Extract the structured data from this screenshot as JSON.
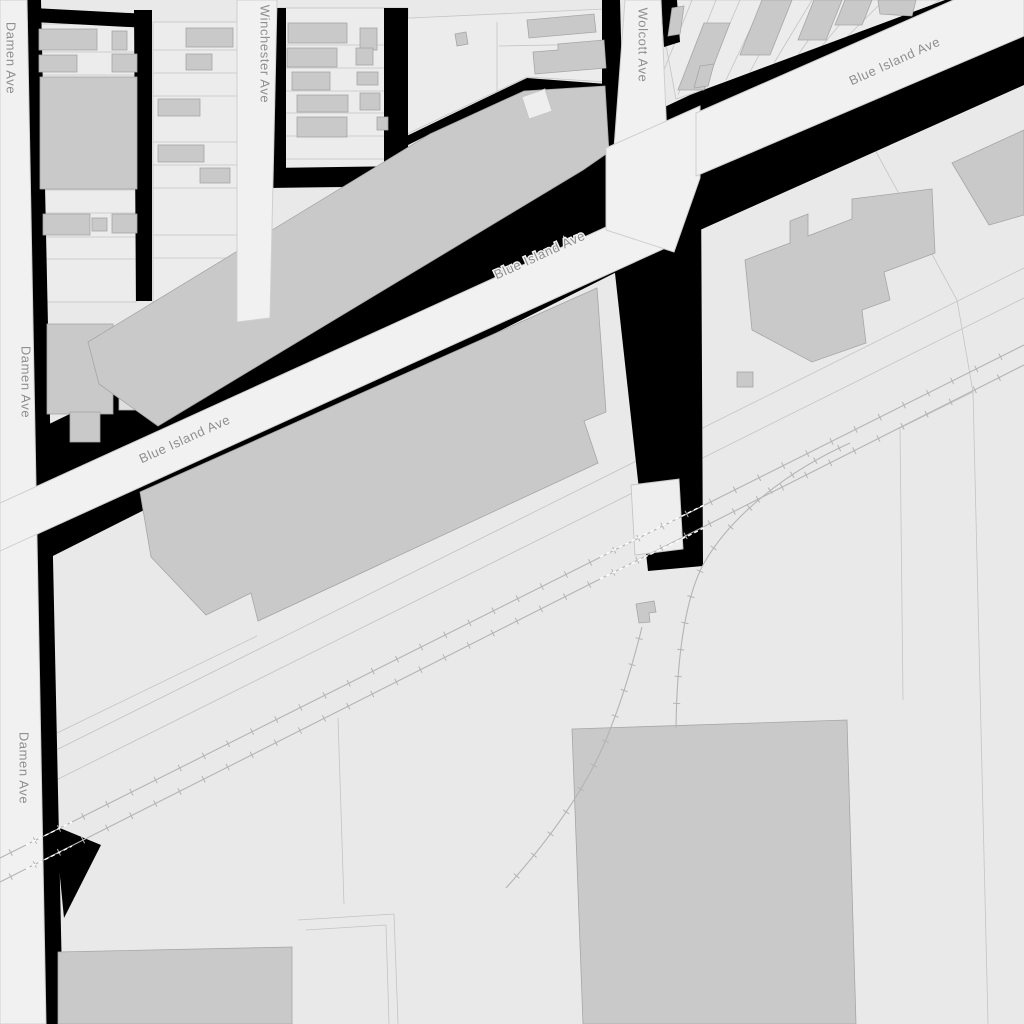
{
  "map": {
    "type": "street-map",
    "street_labels": {
      "damen_top": "Damen Ave",
      "damen_mid": "Damen Ave",
      "damen_bottom": "Damen Ave",
      "winchester": "Winchester Ave",
      "wolcott": "Wolcott Ave",
      "blue_island_west": "Blue Island Ave",
      "blue_island_mid": "Blue Island Ave",
      "blue_island_east": "Blue Island Ave"
    },
    "features": {
      "roads": [
        "Damen Ave",
        "Winchester Ave",
        "Wolcott Ave",
        "Blue Island Ave"
      ],
      "railroad": "twin hatched tracks with two curved spur tracks",
      "buildings": "gray footprints",
      "gaps": "black alley/vacant bands"
    },
    "palette": {
      "background": "#e9e9e9",
      "parcel": "#ececec",
      "road_fill": "#f1f1f1",
      "road_casing": "#cfcfcf",
      "building": "#c9c9c9",
      "building_outline": "#a6a6a6",
      "white_building": "#eeeeee",
      "block_gap": "#000000",
      "rail": "#b4b4b4",
      "label_text": "#8f8f8f",
      "label_halo": "#f2f2f2"
    }
  }
}
